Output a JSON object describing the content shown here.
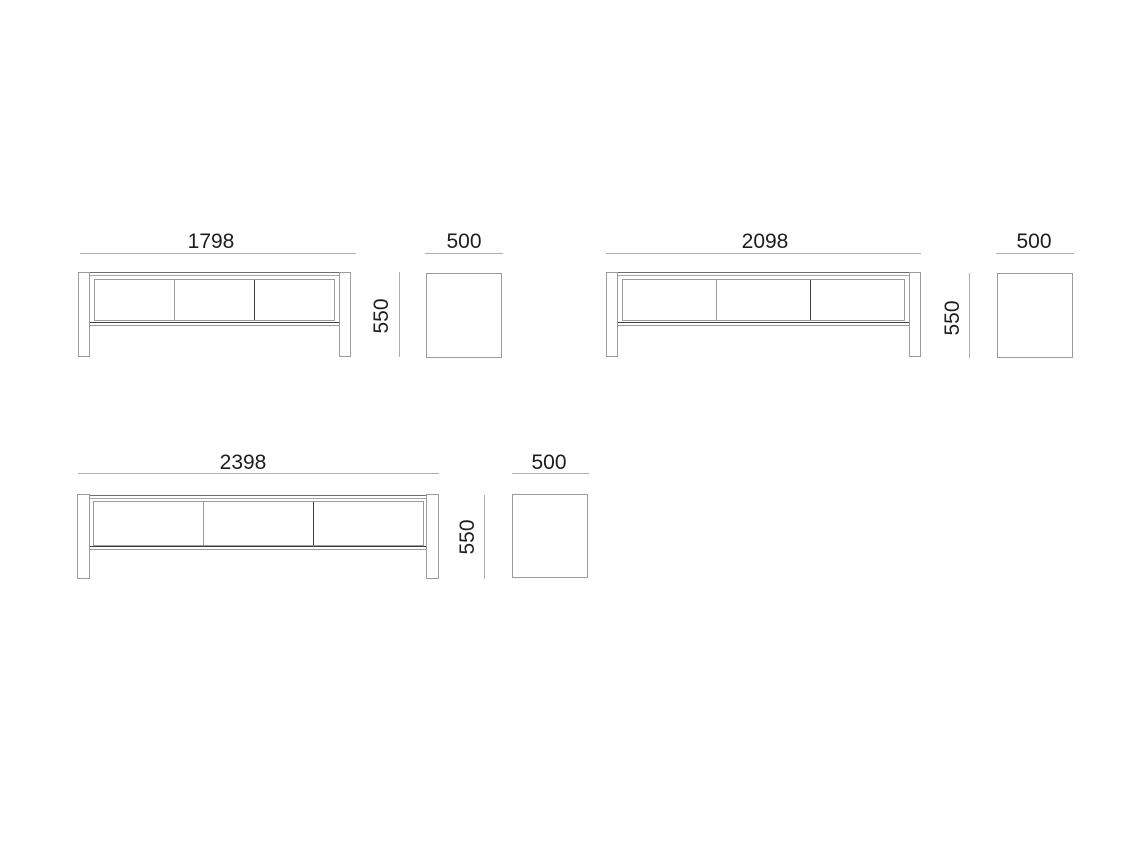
{
  "meta": {
    "type": "furniture-technical-drawing",
    "views_per_variant": [
      "front",
      "side"
    ],
    "units": "mm",
    "drawer_compartments": 3
  },
  "colors": {
    "background": "#ffffff",
    "text": "#1d1d1b",
    "dim_line": "#adadad",
    "outline_light": "#9b9b9b",
    "outline_medium": "#6e6e6e",
    "outline_faint": "#a6a6a6",
    "outline_dark": "#3e3e3e"
  },
  "variants_summary": [
    {
      "width": "1798",
      "height": "550",
      "depth": "500"
    },
    {
      "width": "2098",
      "height": "550",
      "depth": "500"
    },
    {
      "width": "2398",
      "height": "550",
      "depth": "500"
    }
  ],
  "drawings": [
    {
      "name": "tv-stand-1798",
      "width_dim": {
        "label": "1798",
        "text_rect": {
          "x": 151,
          "y": 231,
          "w": 120,
          "h": 22
        },
        "line_rect": {
          "x": 80,
          "y": 253,
          "w": 276,
          "h": 1
        }
      },
      "height_dim": {
        "label": "550",
        "text_rect": {
          "x": 342,
          "y": 305,
          "w": 80,
          "h": 22
        },
        "line_rect": {
          "x": 399,
          "y": 272,
          "w": 1,
          "h": 85
        }
      },
      "depth_dim": {
        "label": "500",
        "text_rect": {
          "x": 404,
          "y": 231,
          "w": 120,
          "h": 22
        },
        "line_rect": {
          "x": 425,
          "y": 253,
          "w": 78,
          "h": 1
        }
      },
      "front": {
        "leg_left": {
          "x": 78,
          "y": 272,
          "w": 12,
          "h": 85
        },
        "leg_right": {
          "x": 339,
          "y": 272,
          "w": 12,
          "h": 85
        },
        "top_band": {
          "x": 78,
          "y": 272,
          "w": 273,
          "h": 4
        },
        "drawer_box": {
          "x": 94,
          "y": 279,
          "w": 241,
          "h": 42
        },
        "rail": {
          "x": 90,
          "y": 322,
          "w": 249,
          "h": 4
        }
      },
      "side": {
        "rect": {
          "x": 426,
          "y": 273,
          "w": 76,
          "h": 85
        }
      }
    },
    {
      "name": "tv-stand-2098",
      "width_dim": {
        "label": "2098",
        "text_rect": {
          "x": 705,
          "y": 231,
          "w": 120,
          "h": 22
        },
        "line_rect": {
          "x": 606,
          "y": 253,
          "w": 315,
          "h": 1
        }
      },
      "height_dim": {
        "label": "550",
        "text_rect": {
          "x": 913,
          "y": 307,
          "w": 80,
          "h": 22
        },
        "line_rect": {
          "x": 969,
          "y": 273,
          "w": 1,
          "h": 85
        }
      },
      "depth_dim": {
        "label": "500",
        "text_rect": {
          "x": 974,
          "y": 231,
          "w": 120,
          "h": 22
        },
        "line_rect": {
          "x": 996,
          "y": 253,
          "w": 78,
          "h": 1
        }
      },
      "front": {
        "leg_left": {
          "x": 606,
          "y": 272,
          "w": 12,
          "h": 85
        },
        "leg_right": {
          "x": 909,
          "y": 272,
          "w": 12,
          "h": 85
        },
        "top_band": {
          "x": 606,
          "y": 272,
          "w": 315,
          "h": 4
        },
        "drawer_box": {
          "x": 622,
          "y": 279,
          "w": 283,
          "h": 42
        },
        "rail": {
          "x": 618,
          "y": 322,
          "w": 291,
          "h": 4
        }
      },
      "side": {
        "rect": {
          "x": 997,
          "y": 273,
          "w": 76,
          "h": 85
        }
      }
    },
    {
      "name": "tv-stand-2398",
      "width_dim": {
        "label": "2398",
        "text_rect": {
          "x": 183,
          "y": 452,
          "w": 120,
          "h": 22
        },
        "line_rect": {
          "x": 78,
          "y": 473,
          "w": 361,
          "h": 1
        }
      },
      "height_dim": {
        "label": "550",
        "text_rect": {
          "x": 428,
          "y": 526,
          "w": 80,
          "h": 22
        },
        "line_rect": {
          "x": 484,
          "y": 495,
          "w": 1,
          "h": 84
        }
      },
      "depth_dim": {
        "label": "500",
        "text_rect": {
          "x": 489,
          "y": 452,
          "w": 120,
          "h": 22
        },
        "line_rect": {
          "x": 512,
          "y": 473,
          "w": 77,
          "h": 1
        }
      },
      "front": {
        "leg_left": {
          "x": 77,
          "y": 494,
          "w": 13,
          "h": 85
        },
        "leg_right": {
          "x": 426,
          "y": 494,
          "w": 13,
          "h": 85
        },
        "top_band": {
          "x": 77,
          "y": 495,
          "w": 362,
          "h": 4
        },
        "drawer_box": {
          "x": 93,
          "y": 501,
          "w": 331,
          "h": 45
        },
        "rail": {
          "x": 90,
          "y": 546,
          "w": 336,
          "h": 4
        }
      },
      "side": {
        "rect": {
          "x": 512,
          "y": 494,
          "w": 76,
          "h": 84
        }
      }
    }
  ]
}
